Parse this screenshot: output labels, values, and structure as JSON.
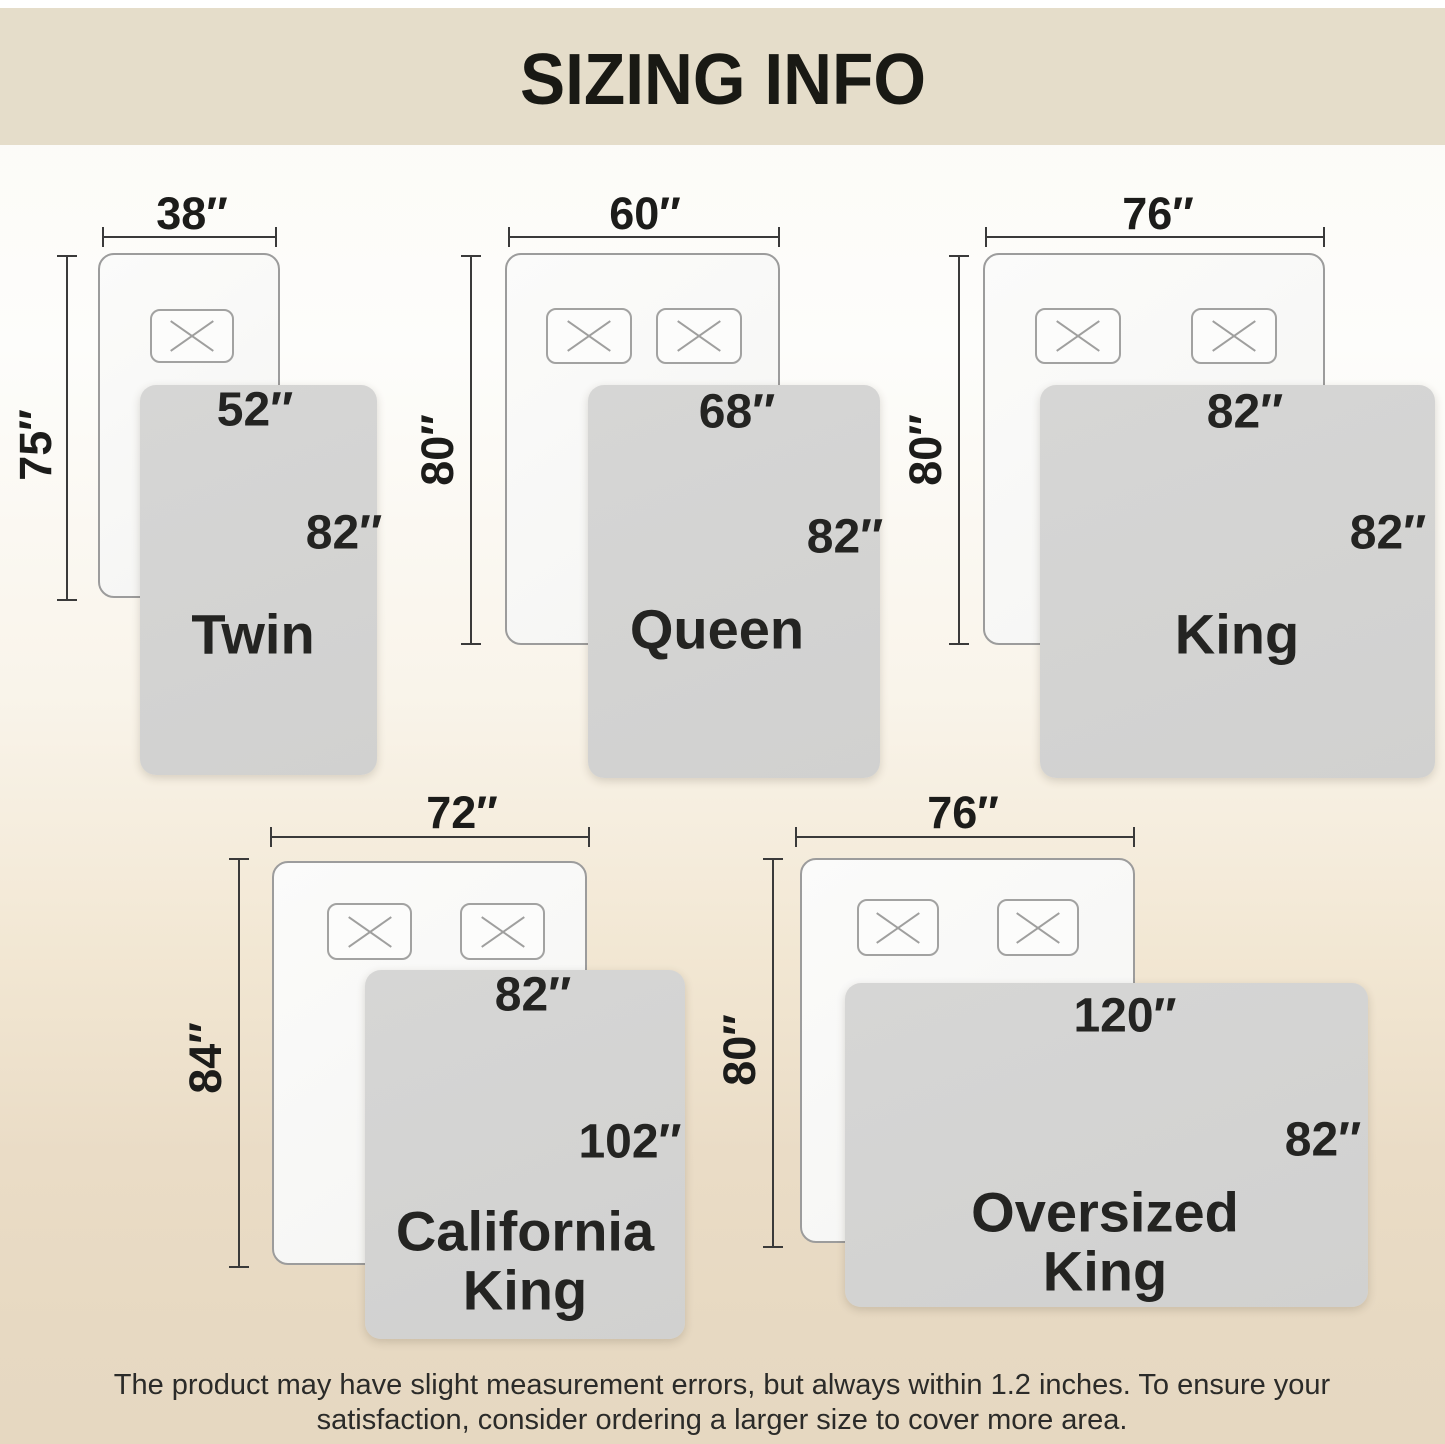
{
  "title": "SIZING INFO",
  "sizes": [
    {
      "name": "Twin",
      "bed_width": "38″",
      "bed_length": "75″",
      "blanket_width": "52″",
      "blanket_length": "82″",
      "pillow_count": 1
    },
    {
      "name": "Queen",
      "bed_width": "60″",
      "bed_length": "80″",
      "blanket_width": "68″",
      "blanket_length": "82″",
      "pillow_count": 2
    },
    {
      "name": "King",
      "bed_width": "76″",
      "bed_length": "80″",
      "blanket_width": "82″",
      "blanket_length": "82″",
      "pillow_count": 2
    },
    {
      "name": "California King",
      "bed_width": "72″",
      "bed_length": "84″",
      "blanket_width": "82″",
      "blanket_length": "102″",
      "pillow_count": 2
    },
    {
      "name": "Oversized King",
      "bed_width": "76″",
      "bed_length": "80″",
      "blanket_width": "120″",
      "blanket_length": "82″",
      "pillow_count": 2
    }
  ],
  "footer": {
    "line1": "The product may have slight measurement errors, but always within 1.2 inches. To ensure your",
    "line2": "satisfaction, consider ordering a larger size to cover more area."
  },
  "colors": {
    "header_bg": "#e5ddca",
    "bottom_beige": "#e6d8c1",
    "blanket_gray": "#d3d3d2",
    "bed_fill": "#f9f9f7",
    "outline_gray": "#9c9c9c",
    "measure_line": "#3a3a3a",
    "text": "#1a1a1a"
  }
}
